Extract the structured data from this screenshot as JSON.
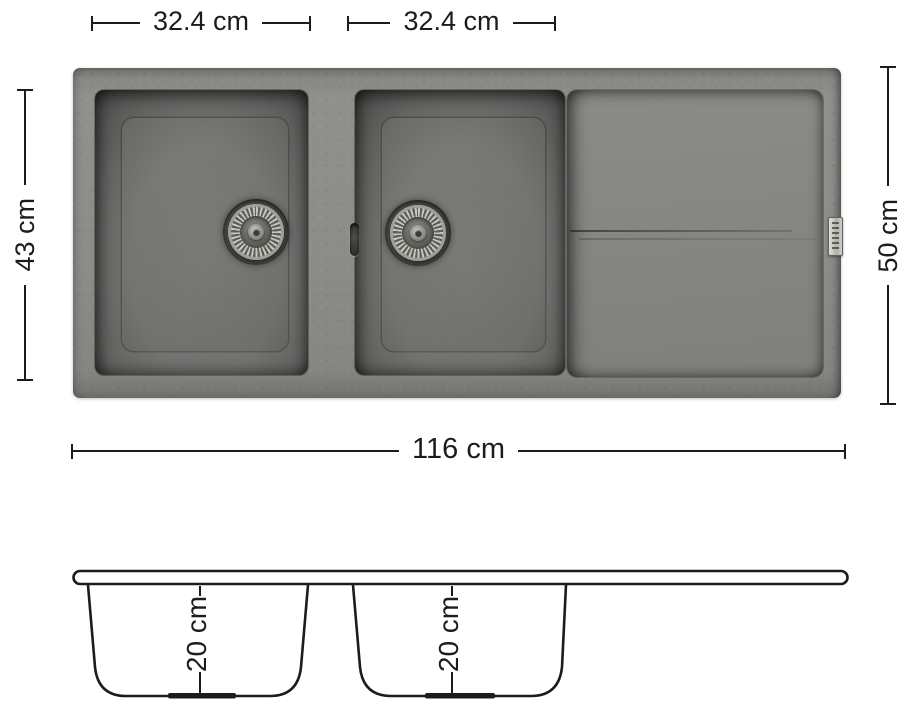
{
  "colors": {
    "background": "#ffffff",
    "line": "#1c1c1c",
    "sink_rim": "#8c8c89",
    "bowl_interior": "#6f6f6d",
    "drainboard": "#878784",
    "drain_metal": "#b9b9b3"
  },
  "top_view": {
    "dims": {
      "bowl1_width": "32.4 cm",
      "bowl2_width": "32.4 cm",
      "inner_height": "43 cm",
      "outer_depth": "50 cm",
      "total_width": "116 cm"
    }
  },
  "section_view": {
    "dims": {
      "bowl1_depth": "20 cm",
      "bowl2_depth": "20 cm"
    }
  }
}
